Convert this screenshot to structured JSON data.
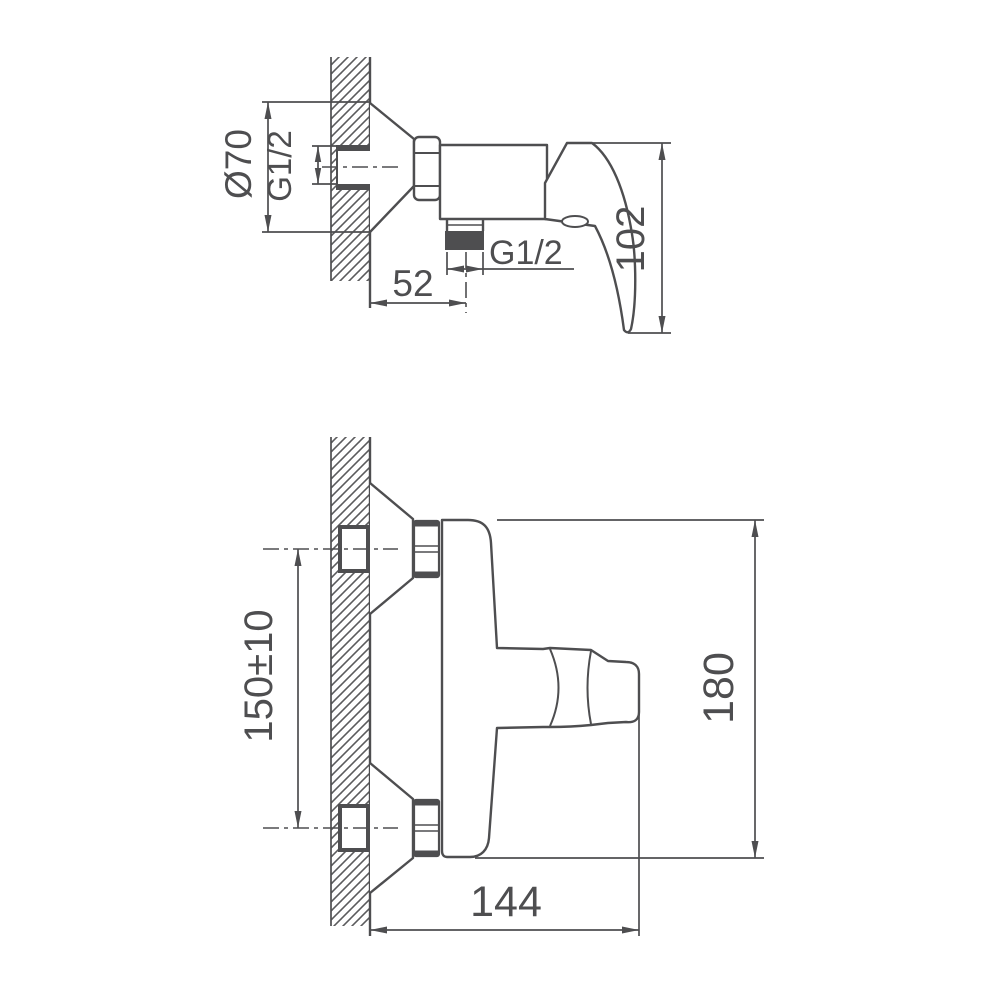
{
  "drawing": {
    "background": "#ffffff",
    "line_color": "#4e4e50",
    "views": {
      "side_view": {
        "dims": {
          "flange_diameter": "Ø70",
          "inlet_thread": "G1/2",
          "handle_height": "102",
          "outlet_offset": "52",
          "outlet_thread": "G1/2"
        }
      },
      "front_view": {
        "dims": {
          "inlet_spacing": "150±10",
          "overall_height": "180",
          "overall_depth": "144"
        }
      }
    }
  }
}
